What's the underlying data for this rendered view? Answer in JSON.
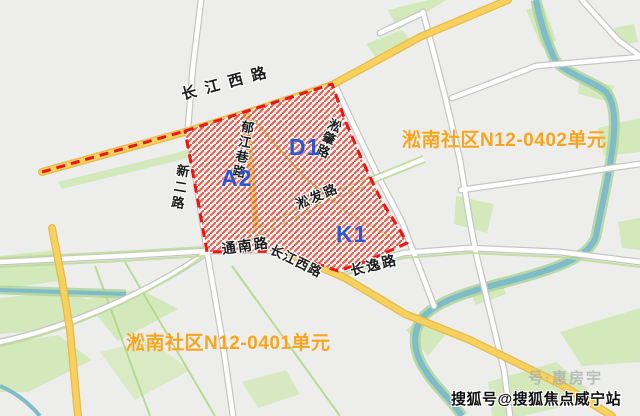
{
  "image_type": "urban-planning-map-screenshot",
  "plots": {
    "a2": "A2",
    "d1": "D1",
    "k1": "K1"
  },
  "roads": {
    "changjiang_west_top": "长江西路",
    "xin_er": "新二路",
    "yujiang_xiang": "郁江巷路",
    "songzhao": "淞肇路",
    "songfa": "淞发路",
    "tongnan": "通南路",
    "changjiang_west_south": "长江西路",
    "changyi": "长逸路"
  },
  "units": {
    "n12_0402": "淞南社区N12-0402单元",
    "n12_0401": "淞南社区N12-0401单元"
  },
  "watermark": {
    "main": "搜狐号@搜狐焦点威宁站",
    "ghost": "号·惠房宇"
  },
  "colors": {
    "background": "#edeeec",
    "zone_hatch": "#ea5f51",
    "zone_border": "#ee1511",
    "zone_base": "#fdf4f2",
    "plot_code_blue": "#2a55d6",
    "unit_label_orange": "#f7a41e",
    "major_road_yellow": "#f8d15c",
    "water_teal": "#7fbcc9",
    "greenery": "#d3e8bb"
  }
}
